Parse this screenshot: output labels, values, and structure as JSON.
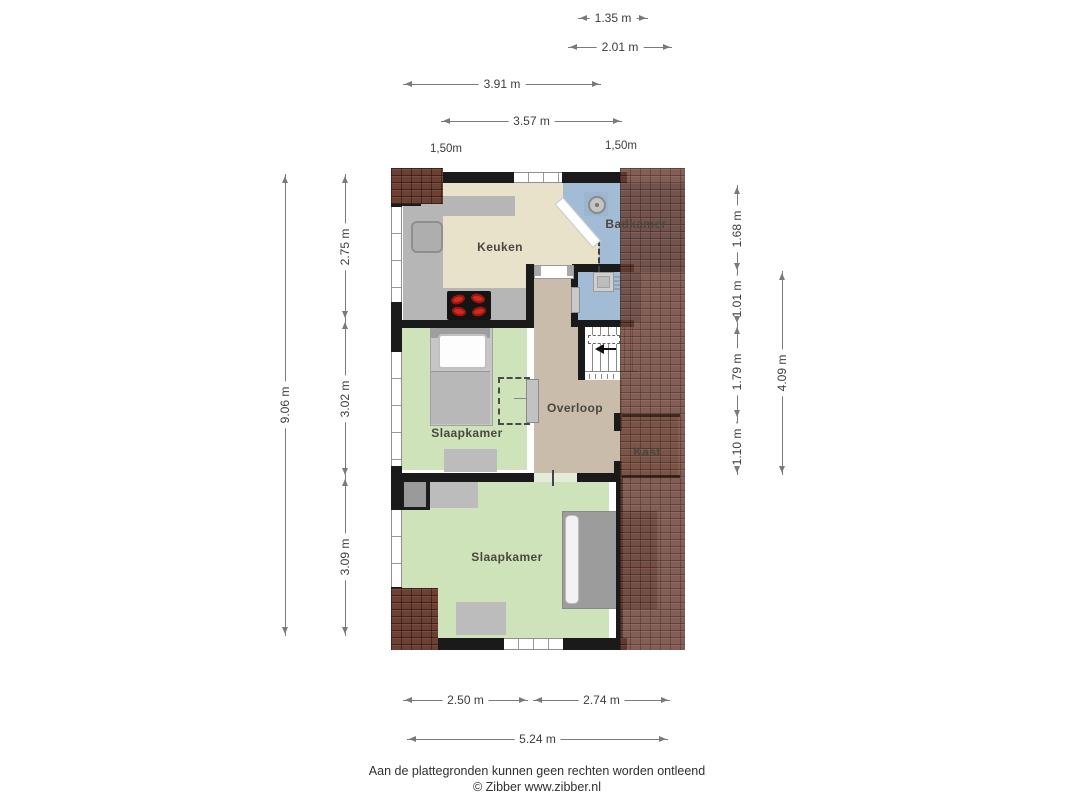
{
  "rooms": [
    {
      "label": "Keuken"
    },
    {
      "label": "Badkamer"
    },
    {
      "label": "Overloop"
    },
    {
      "label": "Kast"
    },
    {
      "label": "Slaapkamer"
    },
    {
      "label": "Slaapkamer"
    }
  ],
  "dimensions": {
    "top": [
      {
        "label": "1.35 m"
      },
      {
        "label": "2.01 m"
      },
      {
        "label": "3.91 m"
      },
      {
        "label": "3.57 m"
      }
    ],
    "top_texts": [
      {
        "label": "1,50m"
      },
      {
        "label": "1,50m"
      }
    ],
    "left": [
      {
        "label": "9.06 m"
      },
      {
        "label": "2.75 m"
      },
      {
        "label": "3.02 m"
      },
      {
        "label": "3.09 m"
      }
    ],
    "right": [
      {
        "label": "1.68 m"
      },
      {
        "label": "1.01 m"
      },
      {
        "label": "1.79 m"
      },
      {
        "label": "1.10 m"
      },
      {
        "label": "4.09 m"
      }
    ],
    "bottom": [
      {
        "label": "2.50 m"
      },
      {
        "label": "2.74 m"
      },
      {
        "label": "5.24 m"
      }
    ]
  },
  "footer": {
    "disclaimer": "Aan de plattegronden kunnen geen rechten worden ontleend",
    "copyright": "© Zibber www.zibber.nl"
  },
  "icons": {
    "shower-icon": "circle-with-dot",
    "sink-icon": "rounded-square",
    "cooktop-icon": "black-rect-4-red-burners",
    "stairs-direction-icon": "left-triangle-arrow",
    "washbasin-icon": "small-square"
  },
  "colors": {
    "wall": "#1a1a1a",
    "kitchen_floor": "#e9e2cb",
    "bathroom_floor": "#a3bcd6",
    "landing_floor": "#c9bcab",
    "closet_floor": "#cdbfae",
    "bedroom_floor": "#cfe3ba",
    "counter": "#b6b6b6",
    "roof_tiles": "#6d4034",
    "burner": "#d42a1e"
  }
}
